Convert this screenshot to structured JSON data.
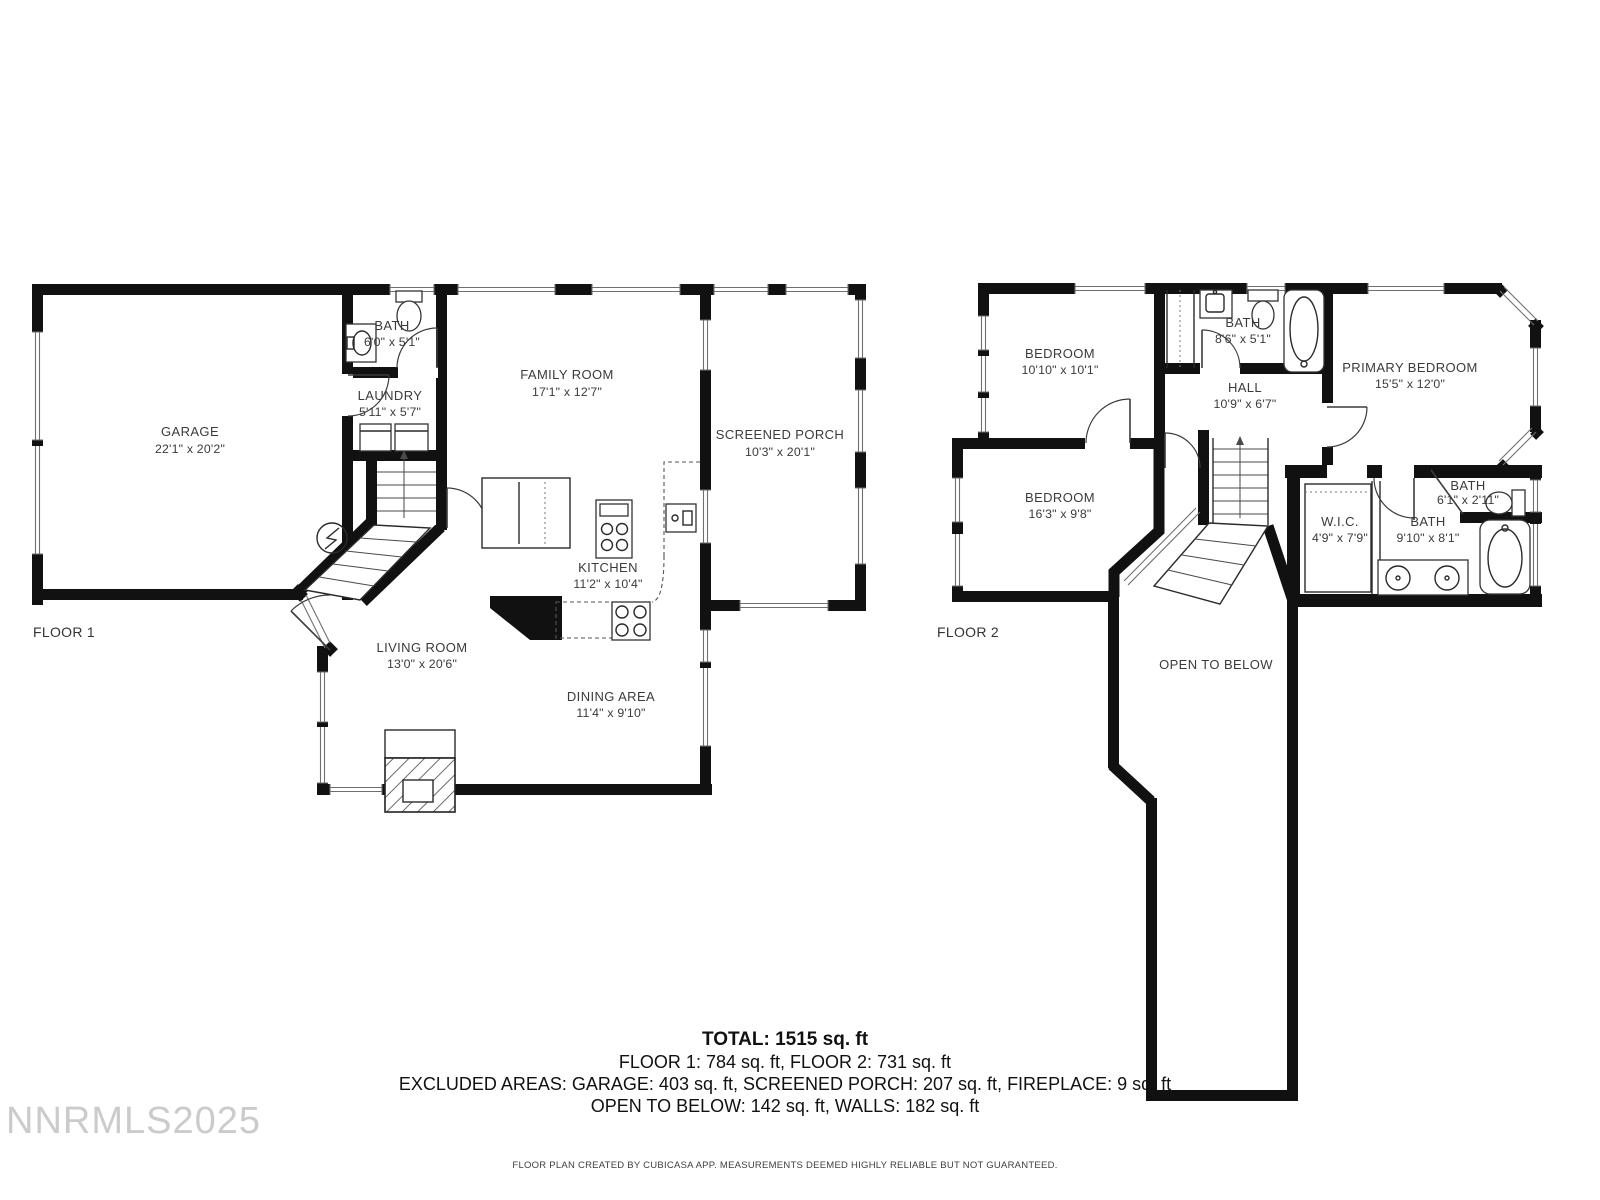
{
  "floor1": {
    "label": "FLOOR 1",
    "rooms": {
      "garage": {
        "name": "GARAGE",
        "dims": "22'1\" x 20'2\""
      },
      "bath": {
        "name": "BATH",
        "dims": "6'0\" x 5'1\""
      },
      "laundry": {
        "name": "LAUNDRY",
        "dims": "5'11\" x 5'7\""
      },
      "family_room": {
        "name": "FAMILY ROOM",
        "dims": "17'1\" x 12'7\""
      },
      "screened_porch": {
        "name": "SCREENED PORCH",
        "dims": "10'3\" x 20'1\""
      },
      "kitchen": {
        "name": "KITCHEN",
        "dims": "11'2\" x 10'4\""
      },
      "living_room": {
        "name": "LIVING ROOM",
        "dims": "13'0\" x 20'6\""
      },
      "dining_area": {
        "name": "DINING AREA",
        "dims": "11'4\" x 9'10\""
      }
    }
  },
  "floor2": {
    "label": "FLOOR 2",
    "rooms": {
      "bedroom1": {
        "name": "BEDROOM",
        "dims": "10'10\" x 10'1\""
      },
      "bath_hall": {
        "name": "BATH",
        "dims": "8'6\" x 5'1\""
      },
      "primary_bedroom": {
        "name": "PRIMARY BEDROOM",
        "dims": "15'5\" x 12'0\""
      },
      "hall": {
        "name": "HALL",
        "dims": "10'9\" x 6'7\""
      },
      "bedroom2": {
        "name": "BEDROOM",
        "dims": "16'3\" x 9'8\""
      },
      "wic": {
        "name": "W.I.C.",
        "dims": "4'9\" x 7'9\""
      },
      "bath_small": {
        "name": "BATH",
        "dims": "6'1\" x 2'11\""
      },
      "bath_primary": {
        "name": "BATH",
        "dims": "9'10\" x 8'1\""
      },
      "open_to_below": {
        "name": "OPEN TO BELOW"
      }
    }
  },
  "summary": {
    "total": "TOTAL: 1515 sq. ft",
    "line2": "FLOOR 1: 784 sq. ft, FLOOR 2: 731 sq. ft",
    "line3": "EXCLUDED AREAS: GARAGE: 403 sq. ft, SCREENED PORCH: 207 sq. ft, FIREPLACE: 9 sq. ft",
    "line4": "OPEN TO BELOW: 142 sq. ft, WALLS: 182 sq. ft"
  },
  "footer": "FLOOR PLAN CREATED BY CUBICASA APP. MEASUREMENTS DEEMED HIGHLY RELIABLE BUT NOT GUARANTEED.",
  "watermark": "NNRMLS2025",
  "colors": {
    "wall": "#111111",
    "label": "#3b3b3b",
    "watermark": "#bfbfbf"
  }
}
